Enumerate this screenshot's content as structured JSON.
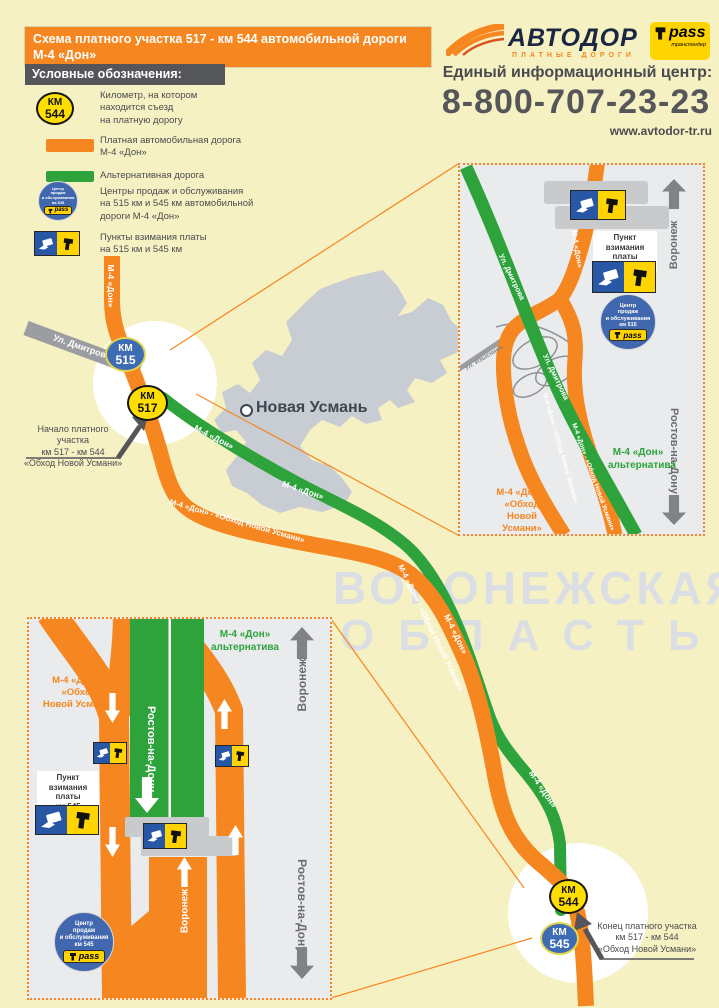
{
  "header": {
    "title": "Схема платного участка 517 - км 544 автомобильной дороги М-4 «Дон»\nв обход с. Новая Усмань"
  },
  "brand": {
    "logo": "АВТОДОР",
    "logo_sub": "ПЛАТНЫЕ ДОРОГИ",
    "tpass": "pass",
    "tpass_sub": "транспондер",
    "info_center": "Единый информационный центр:",
    "phone": "8-800-707-23-23",
    "site": "www.avtodor-tr.ru"
  },
  "legend": {
    "title": "Условные обозначения:",
    "km": {
      "badge_top": "КМ",
      "badge_num": "544",
      "text": "Километр, на котором\nнаходится съезд\nна платную дорогу"
    },
    "toll_road": "Платная автомобильная дорога\nМ-4 «Дон»",
    "alt_road": "Альтернативная дорога",
    "sales": {
      "badge": "Центр\nпродаж\nи обслуживания\nна 545",
      "text": "Центры  продаж и обслуживания\nна 515 км и 545 км автомобильной\nдороги М-4 «Дон»"
    },
    "toll_points": "Пункты взимания платы\nна 515 км и 545 км"
  },
  "map": {
    "town": "Новая Усмань",
    "watermark1": "ВОРОНЕЖСКАЯ",
    "watermark2": "ОБЛАСТЬ",
    "street": "Ул. Дмитрова",
    "labels": {
      "m4": "М-4 «Дон»",
      "m4_obhod": "М-4 «Дон» - «Обход Новой Усмани»"
    },
    "badges": {
      "km515": {
        "t": "КМ",
        "n": "515"
      },
      "km517": {
        "t": "КМ",
        "n": "517"
      },
      "km544": {
        "t": "КМ",
        "n": "544"
      },
      "km545": {
        "t": "КМ",
        "n": "545"
      }
    },
    "start_callout": "Начало платного участка\nкм 517 - км 544\n«Обход Новой Усмани»",
    "end_callout": "Конец платного участка\nкм 517 - км 544\n«Обход Новой Усмани»"
  },
  "inset515": {
    "toll_point": "Пункт\nвзимания платы\nкм 515",
    "sales": "Центр\nпродаж\nи обслуживания\nкм 515",
    "street_green": "Ул. Дмитрова",
    "street_gray": "Ул. Изыскина",
    "alt": "М-4 «Дон»\nальтернатива",
    "obhod": "М-4 «Дон»-\n«Обход\nНовой Усмани»",
    "dir_up": "Воронеж",
    "dir_down": "Ростов-на-Дону"
  },
  "inset545": {
    "toll_point": "Пункт\nвзимания платы\nкм 545",
    "sales": "Центр\nпродаж\nи обслуживания\nкм 545",
    "alt": "М-4 «Дон»\nальтернатива",
    "obhod": "М-4 «Дон» -\n«Обход\nНовой Усмани»",
    "green_road_dir": "Ростов-на-Дону",
    "orange_road_dir": "Воронеж",
    "dir_up": "Воронеж",
    "dir_down": "Ростов-на-Дону"
  },
  "colors": {
    "toll_road": "#F6861F",
    "alt_road": "#2EA33C",
    "accent_blue": "#3D6CB4",
    "badge_yellow": "#FFDE00"
  }
}
